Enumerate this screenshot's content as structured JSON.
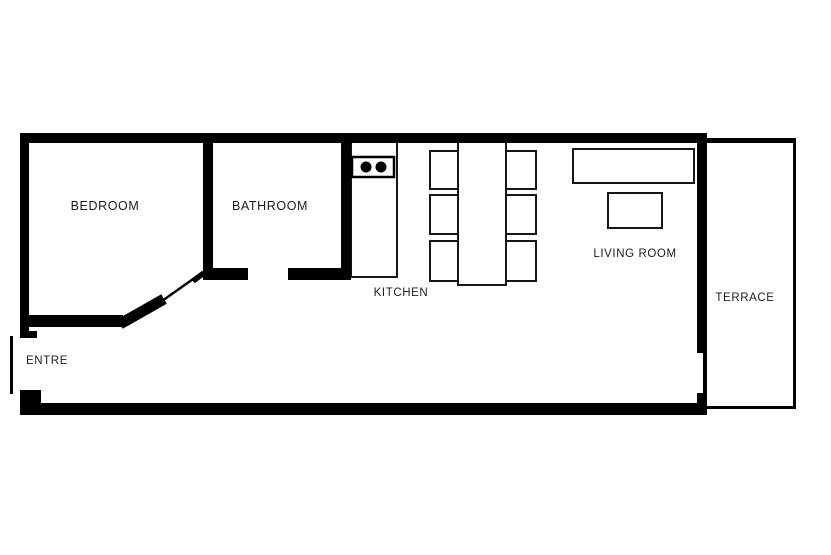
{
  "canvas": {
    "width": 831,
    "height": 555,
    "background": "#ffffff"
  },
  "colors": {
    "wall": "#000000",
    "furniture_stroke": "#161616",
    "label_text": "#1c1c1c"
  },
  "floorplan": {
    "type": "apartment-floor-plan",
    "rooms": [
      {
        "id": "bedroom",
        "label": "BEDROOM"
      },
      {
        "id": "bathroom",
        "label": "BATHROOM"
      },
      {
        "id": "kitchen",
        "label": "KITCHEN"
      },
      {
        "id": "living-room",
        "label": "LIVING ROOM"
      },
      {
        "id": "terrace",
        "label": "TERRACE"
      },
      {
        "id": "entre",
        "label": "ENTRE"
      }
    ],
    "furniture": {
      "stove": {
        "icon": "stove-icon",
        "burners": 2
      },
      "dining_set": {
        "icon": "dining-table-icon",
        "chairs": 6
      },
      "sofa": {
        "icon": "sofa-icon"
      },
      "coffee_table": {
        "icon": "coffee-table-icon"
      }
    }
  }
}
